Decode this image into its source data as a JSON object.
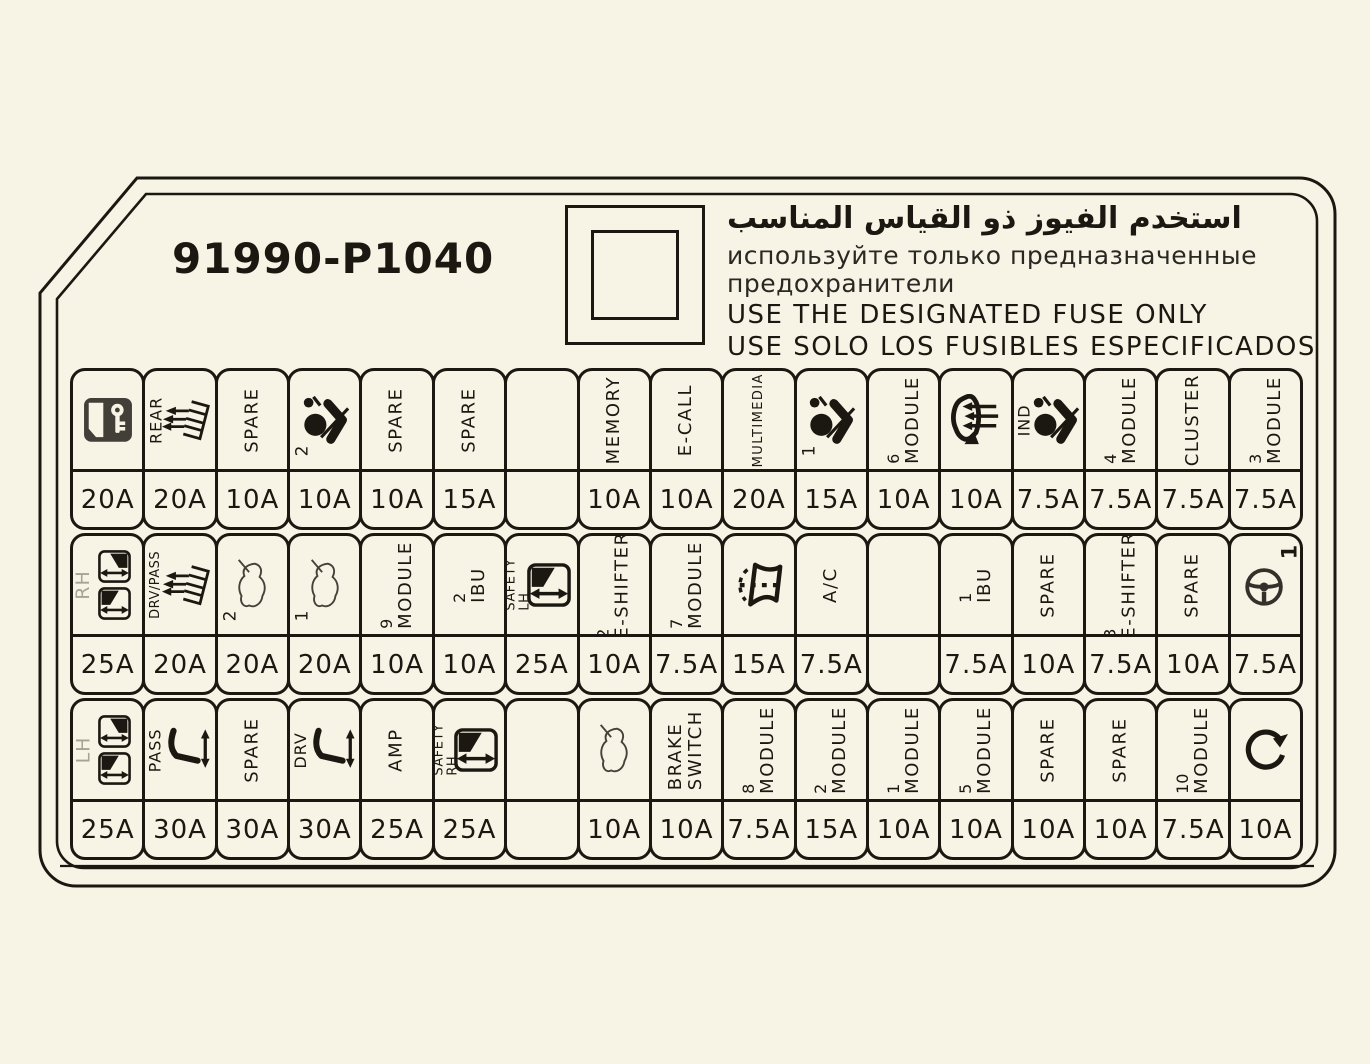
{
  "part_number": "91990-P1040",
  "notice": {
    "arabic": "استخدم الفيوز ذو القياس المناسب",
    "russian_line1": "используйте только предназначенные",
    "russian_line2": "предохранители",
    "english": "USE THE DESIGNATED FUSE ONLY",
    "spanish": "USE SOLO LOS FUSIBLES ESPECIFICADOS"
  },
  "colors": {
    "background": "#f7f4e6",
    "line": "#1b1812",
    "muted_label": "#a7a294"
  },
  "fuse_grid": {
    "rows": [
      {
        "cells": [
          {
            "icon": "door-lock",
            "amp": "20A"
          },
          {
            "side": "REAR",
            "icon": "heater-grid",
            "amp": "20A"
          },
          {
            "label": "SPARE",
            "amp": "10A"
          },
          {
            "icon": "airbag",
            "num": "2",
            "amp": "10A"
          },
          {
            "label": "SPARE",
            "amp": "10A"
          },
          {
            "label": "SPARE",
            "amp": "15A"
          },
          {
            "amp": ""
          },
          {
            "label": "MEMORY",
            "amp": "10A"
          },
          {
            "label": "E-CALL",
            "amp": "10A"
          },
          {
            "label": "MULTIMEDIA",
            "small": true,
            "amp": "20A"
          },
          {
            "icon": "airbag",
            "num": "1",
            "amp": "15A"
          },
          {
            "label": "MODULE",
            "num": "6",
            "amp": "10A"
          },
          {
            "icon": "heated-mirror",
            "amp": "10A"
          },
          {
            "side": "IND",
            "icon": "airbag",
            "amp": "7.5A"
          },
          {
            "label": "MODULE",
            "num": "4",
            "amp": "7.5A"
          },
          {
            "label": "CLUSTER",
            "amp": "7.5A"
          },
          {
            "label": "MODULE",
            "num": "3",
            "amp": "7.5A"
          }
        ]
      },
      {
        "cells": [
          {
            "side": "RH",
            "side_gray": true,
            "icon": "window-pair",
            "amp": "25A"
          },
          {
            "side": "DRV/PASS",
            "side_small": true,
            "icon": "heater-grid",
            "amp": "20A"
          },
          {
            "icon": "car-silhouette",
            "num": "2",
            "amp": "20A"
          },
          {
            "icon": "car-silhouette",
            "num": "1",
            "amp": "20A"
          },
          {
            "label": "MODULE",
            "num": "9",
            "amp": "10A"
          },
          {
            "label": "IBU",
            "num": "2",
            "amp": "10A"
          },
          {
            "side": "SAFETY\nLH",
            "side_small": true,
            "icon": "window",
            "amp": "25A"
          },
          {
            "label": "E-SHIFTER",
            "num": "2",
            "amp": "10A"
          },
          {
            "label": "MODULE",
            "num": "7",
            "amp": "7.5A"
          },
          {
            "icon": "washer",
            "amp": "15A"
          },
          {
            "label": "A/C",
            "amp": "7.5A"
          },
          {
            "amp": ""
          },
          {
            "label": "IBU",
            "num": "1",
            "amp": "7.5A"
          },
          {
            "label": "SPARE",
            "amp": "10A"
          },
          {
            "label": "E-SHIFTER",
            "num": "3",
            "amp": "7.5A"
          },
          {
            "label": "SPARE",
            "amp": "10A"
          },
          {
            "icon": "steering",
            "num": "1",
            "num_pos": "tr",
            "amp": "7.5A"
          }
        ]
      },
      {
        "cells": [
          {
            "side": "LH",
            "side_gray": true,
            "icon": "window-pair",
            "amp": "25A"
          },
          {
            "side": "PASS",
            "icon": "power-seat",
            "amp": "30A"
          },
          {
            "label": "SPARE",
            "amp": "30A"
          },
          {
            "side": "DRV",
            "icon": "power-seat",
            "amp": "30A"
          },
          {
            "label": "AMP",
            "amp": "25A"
          },
          {
            "side": "SAFETY\nRH",
            "side_small": true,
            "icon": "window",
            "amp": "25A"
          },
          {
            "amp": ""
          },
          {
            "icon": "car-silhouette",
            "amp": "10A"
          },
          {
            "label": "BRAKE",
            "label2": "SWITCH",
            "amp": "10A"
          },
          {
            "label": "MODULE",
            "num": "8",
            "amp": "7.5A"
          },
          {
            "label": "MODULE",
            "num": "2",
            "amp": "15A"
          },
          {
            "label": "MODULE",
            "num": "1",
            "amp": "10A"
          },
          {
            "label": "MODULE",
            "num": "5",
            "amp": "10A"
          },
          {
            "label": "SPARE",
            "amp": "10A"
          },
          {
            "label": "SPARE",
            "amp": "10A"
          },
          {
            "label": "MODULE",
            "num": "10",
            "amp": "7.5A"
          },
          {
            "icon": "rotate-arrow",
            "amp": "10A"
          }
        ]
      }
    ]
  }
}
